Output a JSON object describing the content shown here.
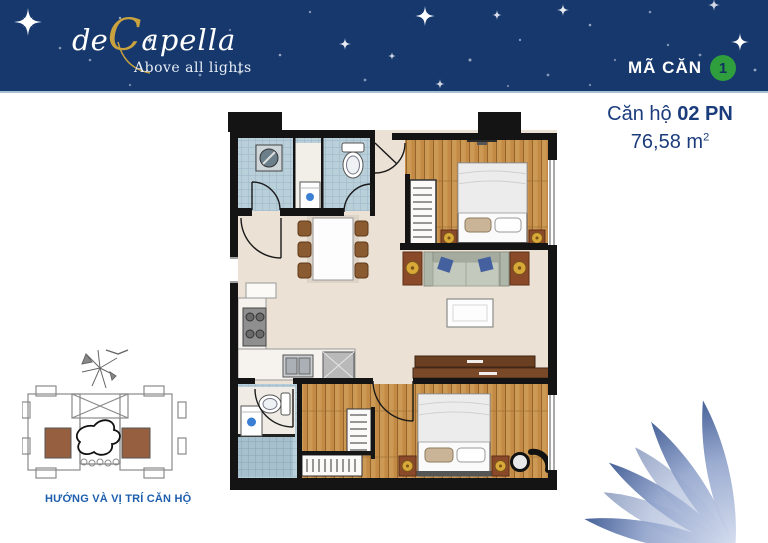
{
  "page": {
    "background": "#ffffff"
  },
  "header": {
    "background_color": "#16386d",
    "logo": {
      "prefix": "de",
      "initial": "C",
      "rest": "apella",
      "tagline": "Above all lights",
      "gold_color": "#c9a23f"
    },
    "unit_code": {
      "label": "MÃ CĂN",
      "value": "1",
      "badge_color": "#2f9e3c",
      "value_color": "#123463"
    }
  },
  "unit_info": {
    "name_regular": "Căn hộ",
    "name_bold": "02 PN",
    "area_value": "76,58",
    "area_unit": "m",
    "area_exponent": "2",
    "text_color": "#1b3c7c"
  },
  "floor_plan": {
    "rooms": [
      "entry",
      "bathroom-1",
      "bedroom-1",
      "living-dining",
      "kitchen",
      "bathroom-2",
      "bedroom-2",
      "walk-in-closet"
    ],
    "colors": {
      "wall": "#141414",
      "floor": "#ebe1d4",
      "tile": "#b9cfda",
      "wood": "#c28a44",
      "cabinet": "#6b3f22",
      "nightstand": "#8a4a2a",
      "lamp": "#d8a838",
      "sofa": "#c3c9bc"
    }
  },
  "site_map": {
    "caption": "HƯỚNG VÀ VỊ TRÍ CĂN HỘ",
    "caption_color": "#1d5fae",
    "unit_highlight_color": "#966040"
  },
  "decoration": {
    "petal_dark": "#274684",
    "petal_light": "#d7dff0",
    "star_color": "#ffffff"
  }
}
